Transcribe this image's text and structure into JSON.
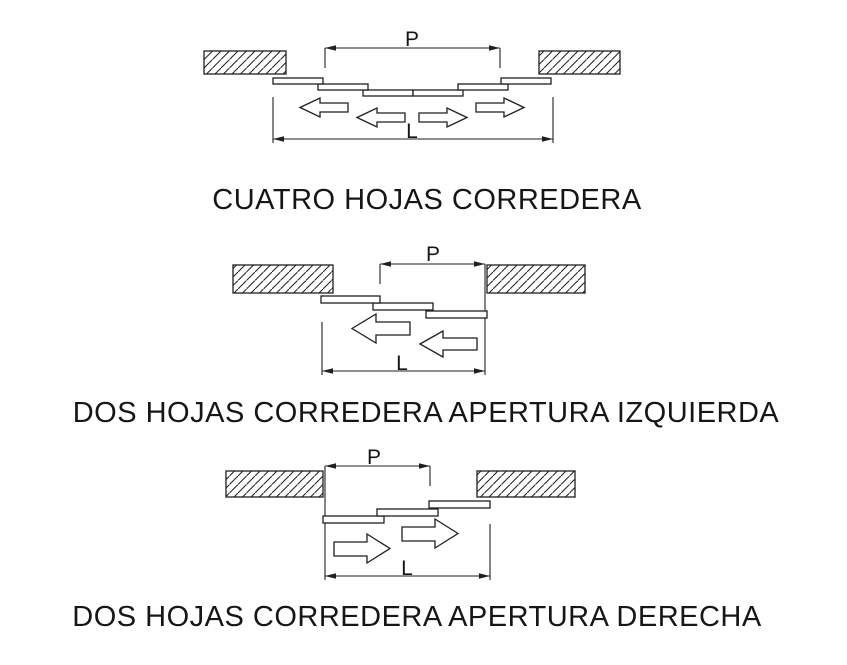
{
  "page": {
    "background_color": "#ffffff",
    "line_color": "#1f1f1f",
    "text_color": "#161616"
  },
  "diagrams": [
    {
      "id": "four-leaf-sliding",
      "caption": "CUATRO HOJAS CORREDERA",
      "labels": {
        "p": "P",
        "l": "L"
      },
      "leaves": 4,
      "opening_direction": "both"
    },
    {
      "id": "two-leaf-sliding-left",
      "caption": "DOS HOJAS CORREDERA APERTURA IZQUIERDA",
      "labels": {
        "p": "P",
        "l": "L"
      },
      "leaves": 2,
      "opening_direction": "left"
    },
    {
      "id": "two-leaf-sliding-right",
      "caption": "DOS HOJAS CORREDERA APERTURA DERECHA",
      "labels": {
        "p": "P",
        "l": "L"
      },
      "leaves": 2,
      "opening_direction": "right"
    }
  ]
}
